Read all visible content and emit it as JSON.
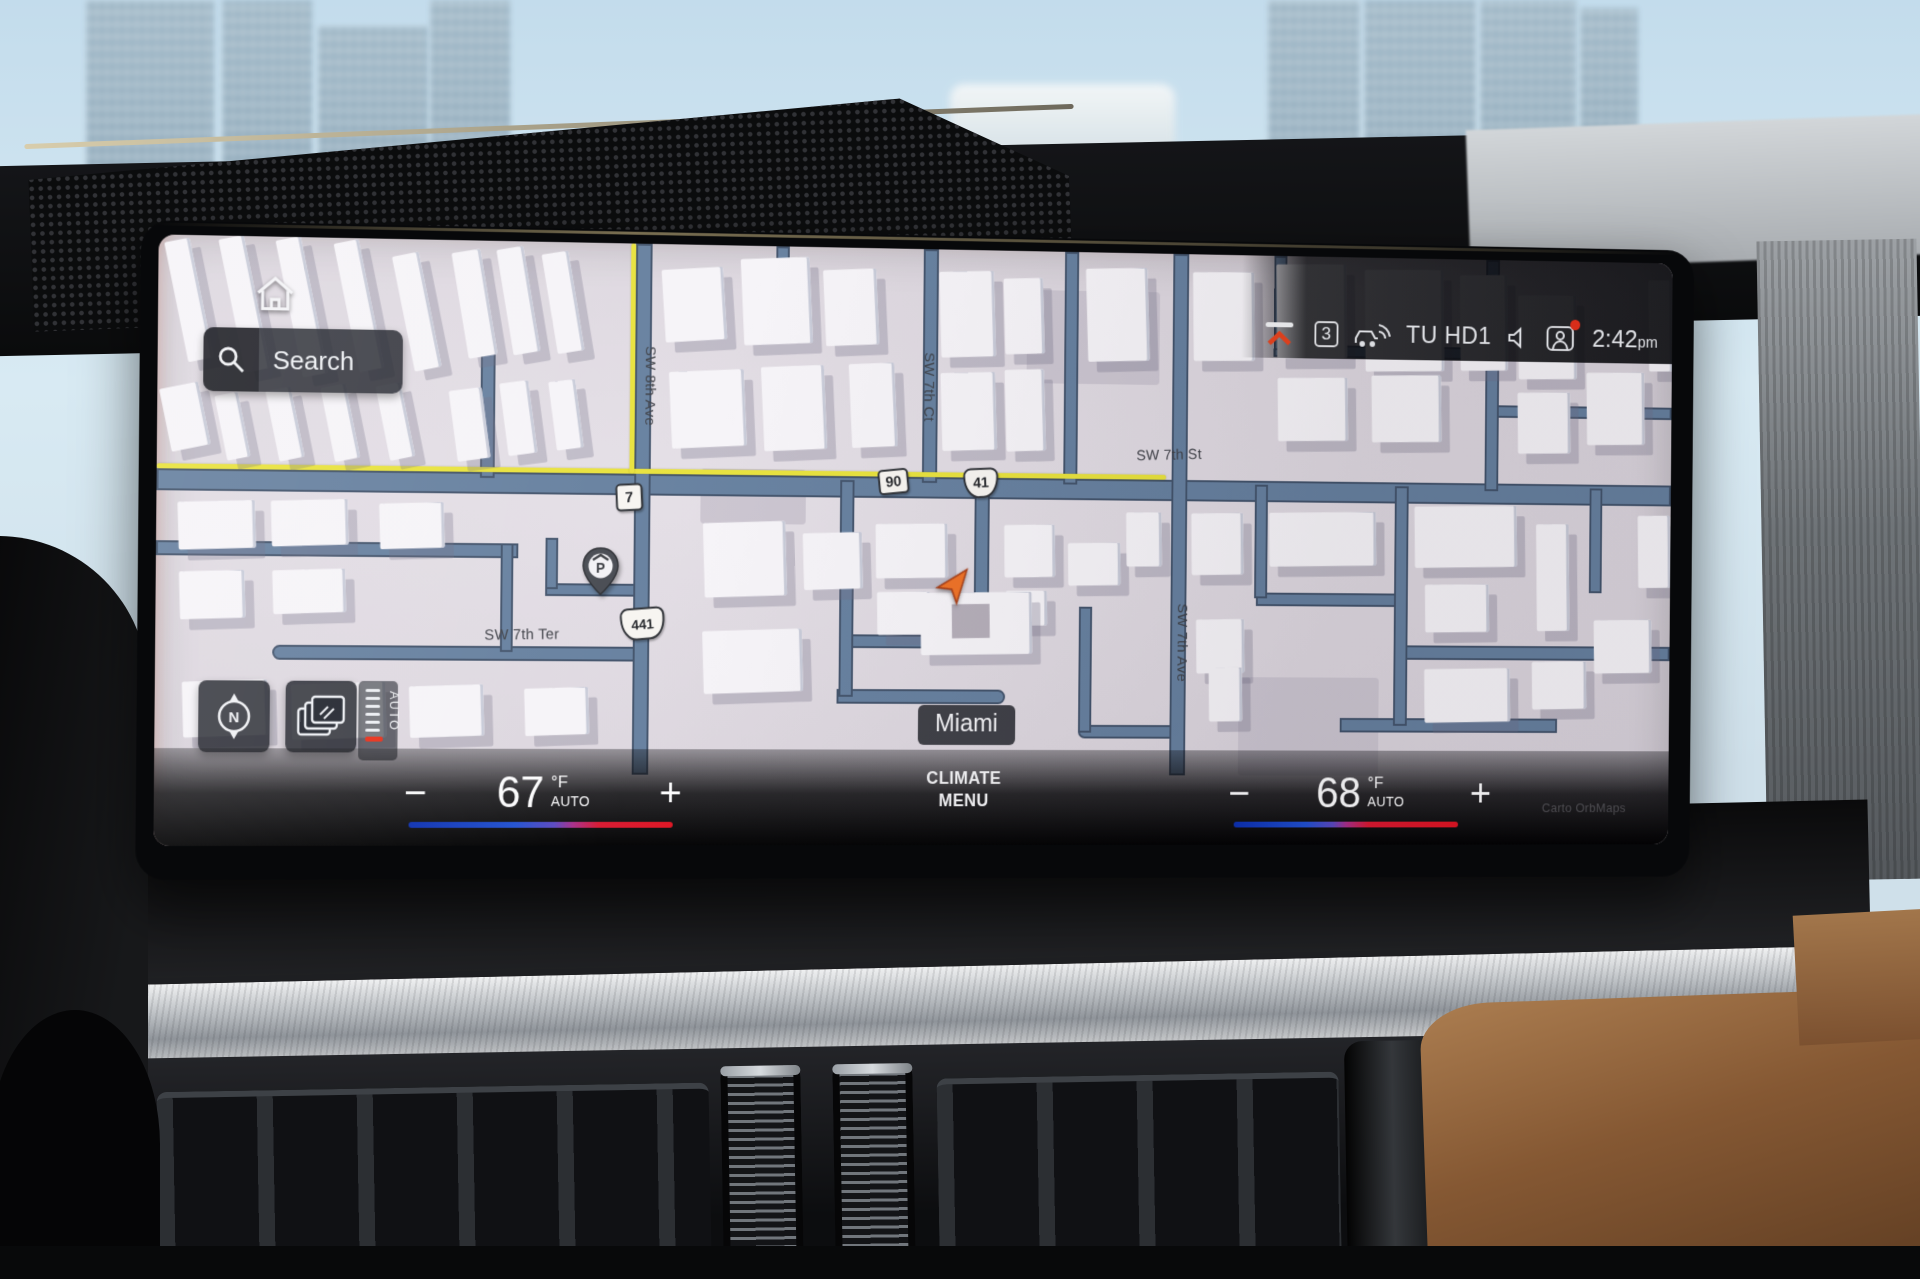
{
  "screen": {
    "search": {
      "label": "Search"
    },
    "status": {
      "badge": "3",
      "station": "TU HD1",
      "time": "2:42",
      "meridiem": "pm"
    },
    "map": {
      "labels": {
        "sw8ave": "SW 8th Ave",
        "sw7ct": "SW 7th Ct",
        "sw7st": "SW 7th St",
        "sw7ter": "SW 7th Ter",
        "sw7ave": "SW 7th Ave"
      },
      "shields": {
        "fl7": "7",
        "us90": "90",
        "us41": "41",
        "us441": "441"
      },
      "city": "Miami",
      "parking": "P",
      "compass": "N",
      "zoom_auto": "AUTO",
      "attribution": "Carto OrbMaps"
    },
    "climate": {
      "left": {
        "minus": "−",
        "temp": "67",
        "unit": "°F",
        "mode": "AUTO",
        "plus": "+"
      },
      "menu_line1": "CLIMATE",
      "menu_line2": "MENU",
      "right": {
        "minus": "−",
        "temp": "68",
        "unit": "°F",
        "mode": "AUTO",
        "plus": "+"
      }
    },
    "icons": {
      "home": "home-icon",
      "search": "magnifier-icon",
      "minimize": "chevron-up-icon",
      "connected_car": "car-wifi-icon",
      "volume": "speaker-icon",
      "driver_profile": "profile-icon",
      "compass": "compass-icon",
      "map_layers": "layers-icon",
      "parking": "parking-pin-icon",
      "vehicle_position": "nav-arrow-icon"
    },
    "colors": {
      "route_highlight": "#e8e23c",
      "accent_red": "#e8431d",
      "cold": "#1b4fd8",
      "hot": "#e01422",
      "road": "#66809f",
      "map_bg": "#ded8e0"
    }
  }
}
